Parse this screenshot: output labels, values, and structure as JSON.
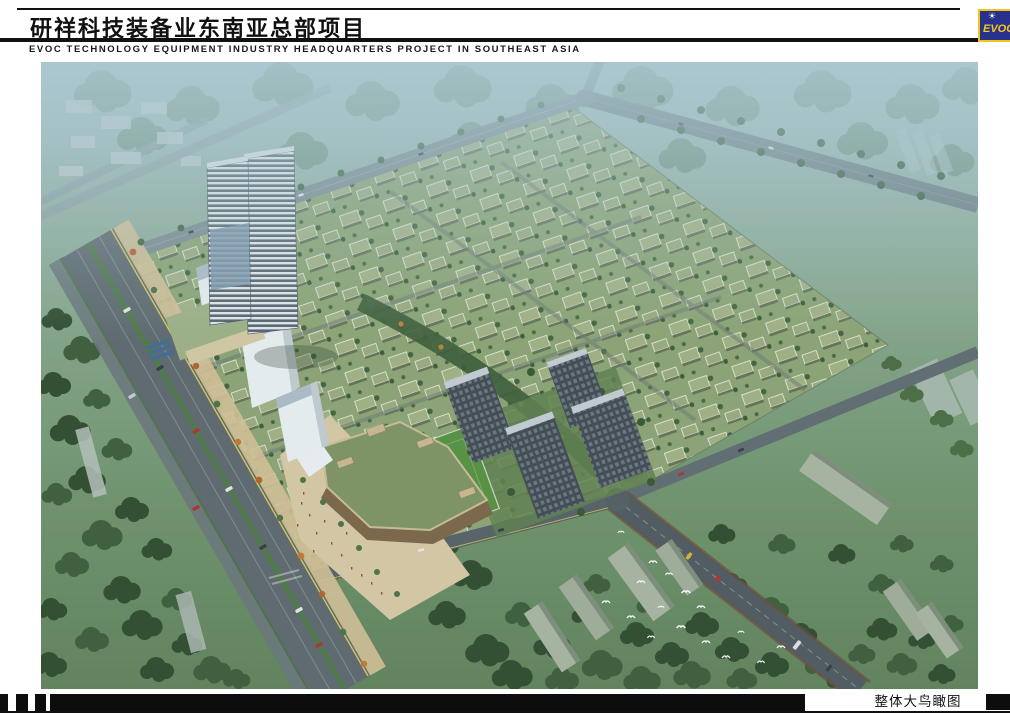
{
  "header": {
    "title_cn": "研祥科技装备业东南亚总部项目",
    "subtitle_en": "EVOC TECHNOLOGY EQUIPMENT INDUSTRY HEADQUARTERS PROJECT IN SOUTHEAST ASIA",
    "logo": {
      "text": "EVOC",
      "icon": "sunburst-icon",
      "colors": {
        "bg": "#28328c",
        "border": "#f2c51d",
        "text": "#f5c81e"
      }
    }
  },
  "figure": {
    "type": "aerial-bird-eye-rendering",
    "caption": "整体大鸟瞰图"
  },
  "palette": {
    "haze_sky": "#a9c3c8",
    "forest_dark": "#2e4a2b",
    "forest_mid": "#3c5c37",
    "road_gray": "#5d676b",
    "road_median_green": "#4e7744",
    "lane_yellow": "#d9ca54",
    "villa_roof_green": "#a3b182",
    "plaza_beige": "#d9c9a3",
    "sports_field_green": "#55913e",
    "residential_tower_dark": "#3f474f",
    "office_tower_light": "#e7eaec",
    "promenade_tree_orange": "#b55f2a"
  }
}
